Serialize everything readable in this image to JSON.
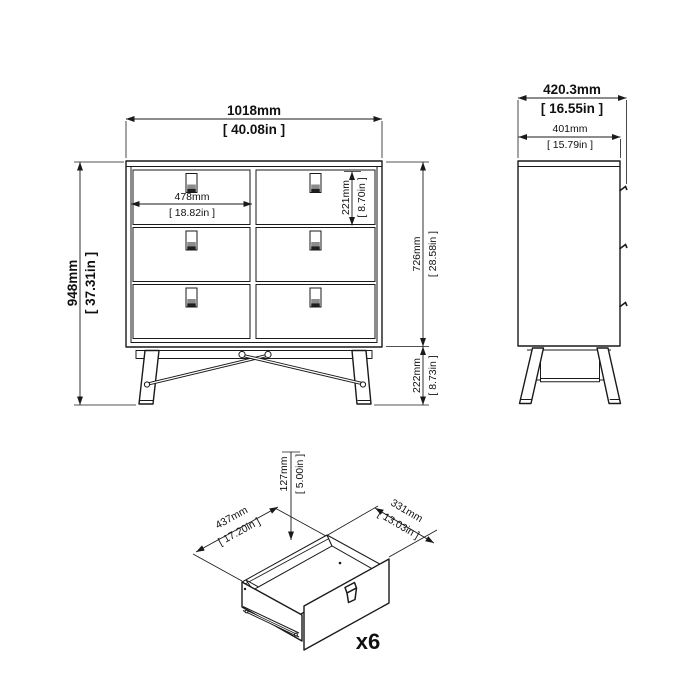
{
  "drawing": {
    "front_view": {
      "overall_width": {
        "mm": "1018mm",
        "in": "[ 40.08in ]"
      },
      "overall_height": {
        "mm": "948mm",
        "in": "[ 37.31in ]"
      },
      "drawer_width": {
        "mm": "478mm",
        "in": "[ 18.82in ]"
      },
      "drawer_height": {
        "mm": "221mm",
        "in": "[ 8.70in ]"
      },
      "carcass_height": {
        "mm": "726mm",
        "in": "[ 28.58in ]"
      },
      "leg_height": {
        "mm": "222mm",
        "in": "[ 8.73in ]"
      }
    },
    "side_view": {
      "overall_depth": {
        "mm": "420.3mm",
        "in": "[ 16.55in ]"
      },
      "carcass_depth": {
        "mm": "401mm",
        "in": "[ 15.79in ]"
      }
    },
    "drawer_detail": {
      "drawer_box_height": {
        "mm": "127mm",
        "in": "[ 5.00in ]"
      },
      "drawer_box_width": {
        "mm": "437mm",
        "in": "[ 17.20in ]"
      },
      "drawer_box_depth": {
        "mm": "331mm",
        "in": "[ 13.03in ]"
      },
      "quantity_label": "x6"
    },
    "colors": {
      "line": "#1a1a1a",
      "background": "#ffffff",
      "handle_gray": "#8c8c8c",
      "handle_dark": "#1f1f1f"
    }
  }
}
